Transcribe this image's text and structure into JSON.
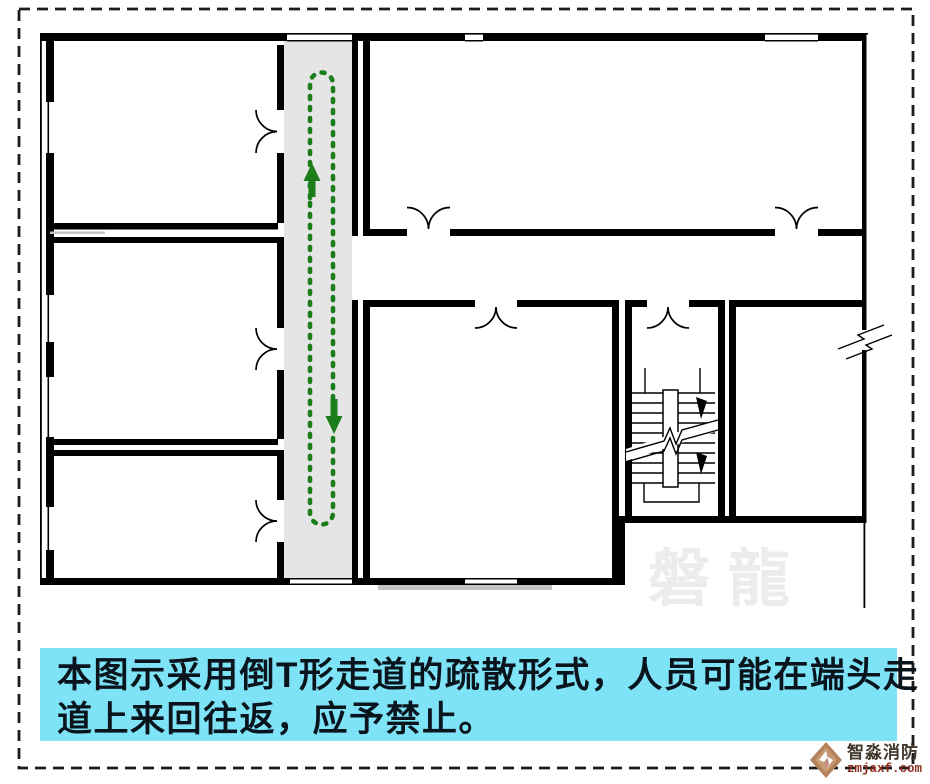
{
  "colors": {
    "border": "#1c1c1c",
    "wall": "#000000",
    "corridor_gray": "#e5e5e5",
    "route_green": "#1b7e1b",
    "caption_bg": "#7ee3f6",
    "caption_text": "#0a141d",
    "watermark_gray": "#ececec",
    "divider_gray": "#c4c4c4",
    "logo_bronze": "#b3815a",
    "logo_name": "#42372d",
    "logo_domain": "#8f2c1e"
  },
  "caption": {
    "line1": "本图示采用倒T形走道的疏散形式，人员可能在端头走",
    "line2": "道上来回往返，应予禁止。"
  },
  "watermark": {
    "text": "磐龍"
  },
  "logo": {
    "name": "智淼消防",
    "domain": "zmjaxf.com"
  }
}
